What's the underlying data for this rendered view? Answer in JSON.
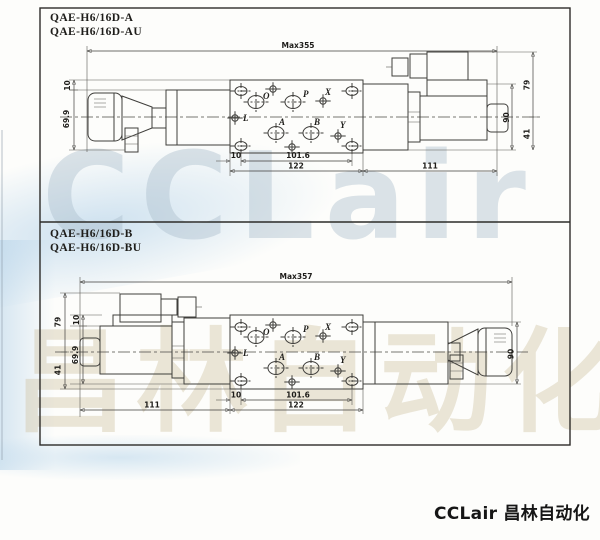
{
  "watermark": {
    "latin": "CCLair",
    "cjk": "昌林自动化"
  },
  "footer": {
    "brand": "CCLair 昌林自动化"
  },
  "panel1": {
    "model1": "QAE-H6/16D-A",
    "model2": "QAE-H6/16D-AU",
    "max": "Max355",
    "d10_left": "10",
    "d699": "69.9",
    "d10_hole": "10",
    "d1016": "101.6",
    "d122": "122",
    "d111": "111",
    "d79": "79",
    "d90": "90",
    "d41": "41",
    "ports": {
      "o": "O",
      "p": "P",
      "x": "X",
      "l": "L",
      "a": "A",
      "b": "B",
      "y": "Y"
    }
  },
  "panel2": {
    "model1": "QAE-H6/16D-B",
    "model2": "QAE-H6/16D-BU",
    "max": "Max357",
    "d79": "79",
    "d10_left": "10",
    "d699": "69.9",
    "d41": "41",
    "d111": "111",
    "d10_hole": "10",
    "d1016": "101.6",
    "d122": "122",
    "d90": "90",
    "ports": {
      "o": "O",
      "p": "P",
      "x": "X",
      "l": "L",
      "a": "A",
      "b": "B",
      "y": "Y"
    }
  }
}
